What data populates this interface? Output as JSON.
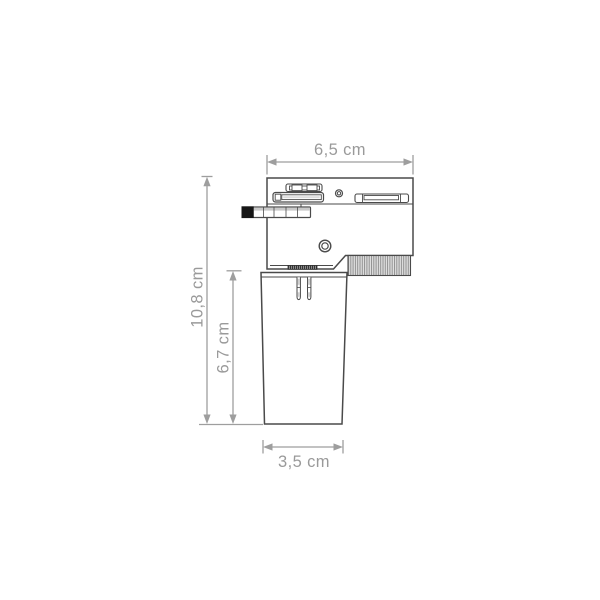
{
  "diagram": {
    "type": "technical-dimension-drawing",
    "dimensions": {
      "top_width": "6,5 cm",
      "total_height": "10,8 cm",
      "holder_height": "6,7 cm",
      "bottom_width": "3,5 cm"
    },
    "colors": {
      "background": "#ffffff",
      "drawing_line": "#4a4a4a",
      "dimension_line": "#9e9e9e",
      "dimension_text": "#9a9a9a",
      "lever_knob": "#161616",
      "rib_fill": "#e0e0e0",
      "rib_line": "#8f8f8f"
    }
  }
}
